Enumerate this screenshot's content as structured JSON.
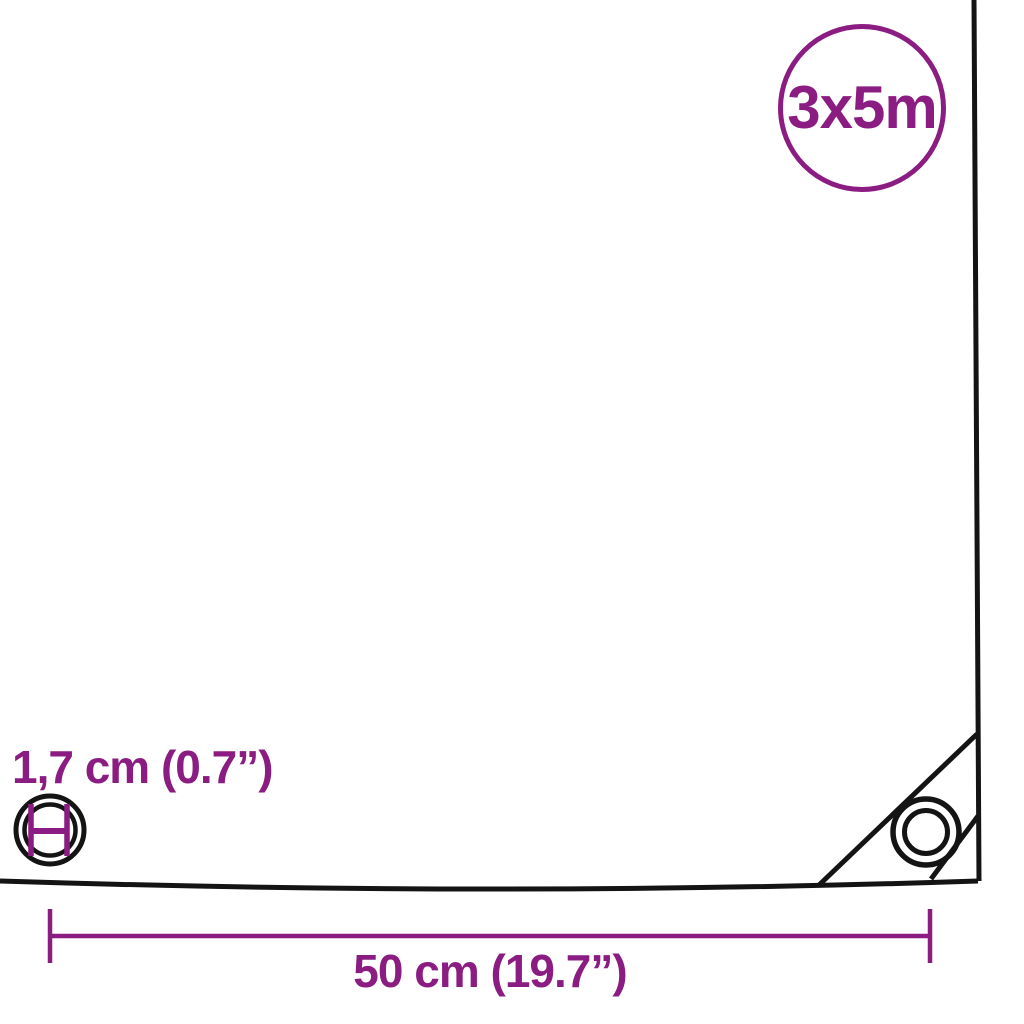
{
  "diagram": {
    "title": "tarpaulin-corner-dimension-diagram",
    "size_badge_label": "3x5m",
    "eyelet_diameter_label": "1,7 cm (0.7”)",
    "eyelet_spacing_label": "50 cm (19.7”)"
  },
  "colors": {
    "accent_purple": "#8B1D82",
    "line_black": "#141414",
    "background": "#ffffff"
  }
}
